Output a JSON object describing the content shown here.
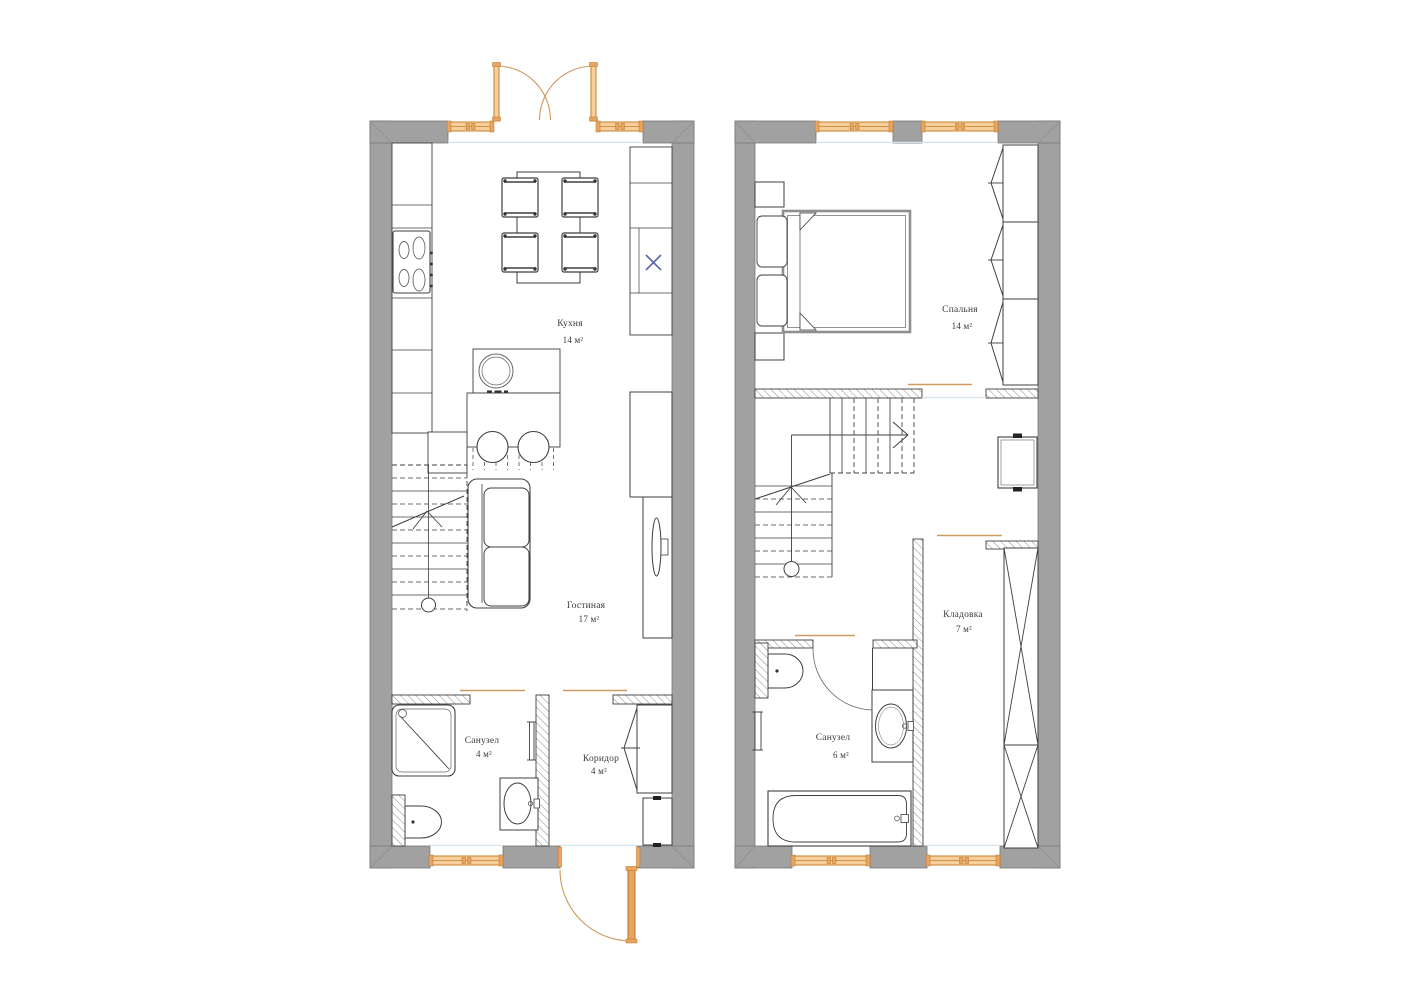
{
  "page": {
    "background": "#ffffff",
    "type": "apartment-floor-plan"
  },
  "colors": {
    "wall": "#a1a1a1",
    "window": "#f7cf9c",
    "window_frame": "#c5802e",
    "door_leaf": "#e9a55e",
    "door_swing": "#cf9a5d",
    "appliance_mark": "#5c66ad",
    "drawing_line": "#3f3f3f",
    "threshold": "#d3e4ec"
  },
  "floors": {
    "first": {
      "id": "floor-1",
      "rooms": [
        {
          "id": "kitchen",
          "name": "Кухня",
          "area": "14 м²"
        },
        {
          "id": "living",
          "name": "Гостиная",
          "area": "17 м²"
        },
        {
          "id": "bathroom",
          "name": "Санузел",
          "area": "4 м²"
        },
        {
          "id": "corridor",
          "name": "Коридор",
          "area": "4 м²"
        }
      ]
    },
    "second": {
      "id": "floor-2",
      "rooms": [
        {
          "id": "bedroom",
          "name": "Спальня",
          "area": "14 м²"
        },
        {
          "id": "storage",
          "name": "Кладовка",
          "area": "7 м²"
        },
        {
          "id": "bathroom",
          "name": "Санузел",
          "area": "6 м²"
        }
      ]
    }
  }
}
